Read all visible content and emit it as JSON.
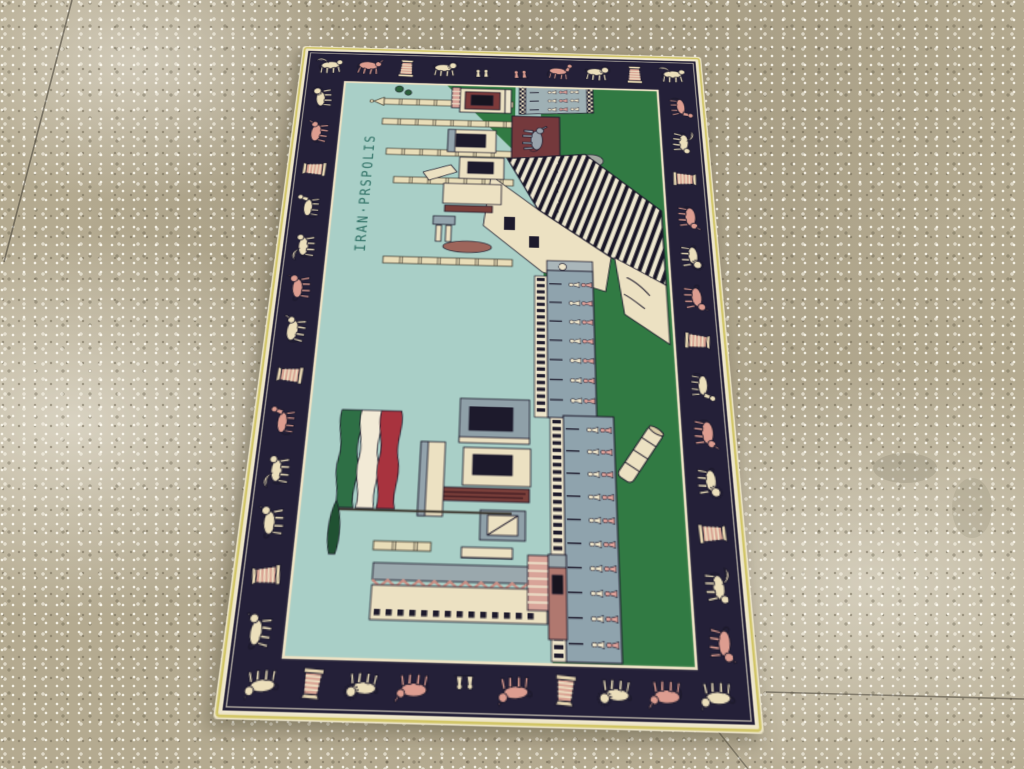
{
  "photo": {
    "subject": "Pictorial Persepolis rug on terrazzo floor"
  },
  "rug": {
    "woven_text": "IRAN·PRSPOLIS",
    "palette": {
      "border_navy": "#242038",
      "edge_cream": "#efe7cc",
      "edge_yellow": "#cfc35e",
      "guard_stripe": "#ece2c4",
      "sky": "#a9cfc7",
      "green": "#317a43",
      "cream": "#ece1c2",
      "slate": "#8fa3ad",
      "slate_light": "#9fb0b4",
      "maroon": "#7a3f3a",
      "pink_stripe": "#d8a398",
      "outline": "#1d1a2c",
      "motif_cream": "#ecdfbb",
      "motif_pink": "#dd9d90",
      "figure_pink": "#e0a39a",
      "figure_cream": "#efe6cb",
      "bull_gray": "#98a2ab",
      "text_teal": "#2d6e63",
      "flag_green": "#2e6f45",
      "flag_white": "#f2ead6",
      "flag_red": "#a8333e",
      "cypress_green": "#205132"
    },
    "border_motifs": {
      "top": [
        {
          "type": "winged",
          "tint": "cream"
        },
        {
          "type": "bull",
          "tint": "pink"
        },
        {
          "type": "column",
          "tint": "pink"
        },
        {
          "type": "sphinx",
          "tint": "cream"
        },
        {
          "type": "figures",
          "tint": "cream"
        },
        {
          "type": "figures",
          "tint": "pink"
        },
        {
          "type": "horse",
          "tint": "pink"
        },
        {
          "type": "sphinx",
          "tint": "cream"
        },
        {
          "type": "column",
          "tint": "pink"
        },
        {
          "type": "winged",
          "tint": "cream"
        }
      ],
      "bottom": [
        {
          "type": "lion",
          "tint": "cream"
        },
        {
          "type": "column",
          "tint": "pink"
        },
        {
          "type": "sphinx",
          "tint": "cream"
        },
        {
          "type": "bull",
          "tint": "pink"
        },
        {
          "type": "figures",
          "tint": "cream"
        },
        {
          "type": "lion",
          "tint": "pink"
        },
        {
          "type": "column",
          "tint": "pink"
        },
        {
          "type": "sphinx",
          "tint": "cream"
        },
        {
          "type": "bull",
          "tint": "pink"
        },
        {
          "type": "lion",
          "tint": "cream"
        }
      ],
      "left": [
        {
          "type": "sphinx",
          "tint": "cream"
        },
        {
          "type": "bull",
          "tint": "pink"
        },
        {
          "type": "column",
          "tint": "pink"
        },
        {
          "type": "horse",
          "tint": "cream"
        },
        {
          "type": "winged",
          "tint": "cream"
        },
        {
          "type": "lion",
          "tint": "pink"
        },
        {
          "type": "bull",
          "tint": "cream"
        },
        {
          "type": "column",
          "tint": "pink"
        },
        {
          "type": "horse",
          "tint": "pink"
        },
        {
          "type": "winged",
          "tint": "cream"
        },
        {
          "type": "lion",
          "tint": "cream"
        },
        {
          "type": "column",
          "tint": "pink"
        },
        {
          "type": "lion",
          "tint": "cream"
        }
      ],
      "right": [
        {
          "type": "horse",
          "tint": "pink"
        },
        {
          "type": "winged",
          "tint": "cream"
        },
        {
          "type": "column",
          "tint": "pink"
        },
        {
          "type": "bull",
          "tint": "pink"
        },
        {
          "type": "sphinx",
          "tint": "cream"
        },
        {
          "type": "lion",
          "tint": "pink"
        },
        {
          "type": "column",
          "tint": "pink"
        },
        {
          "type": "horse",
          "tint": "cream"
        },
        {
          "type": "bull",
          "tint": "pink"
        },
        {
          "type": "sphinx",
          "tint": "cream"
        },
        {
          "type": "column",
          "tint": "pink"
        },
        {
          "type": "winged",
          "tint": "cream"
        },
        {
          "type": "lion",
          "tint": "pink"
        }
      ]
    },
    "frieze": {
      "upper_rows": 7,
      "lower_rows": 10,
      "relief_rows": 3
    },
    "depicted_elements": [
      "persepolis-columns",
      "great-staircase",
      "procession-frieze",
      "gate-building",
      "bull-relief",
      "iran-flag",
      "fallen-column",
      "cypress-tree",
      "ruined-walls"
    ]
  },
  "floor": {
    "base_color": "#b4aa90",
    "speckle_light": "#f4efe2",
    "speckle_dark": "#6e6753",
    "seam_color": "#4a453a",
    "seam_count": 3
  }
}
